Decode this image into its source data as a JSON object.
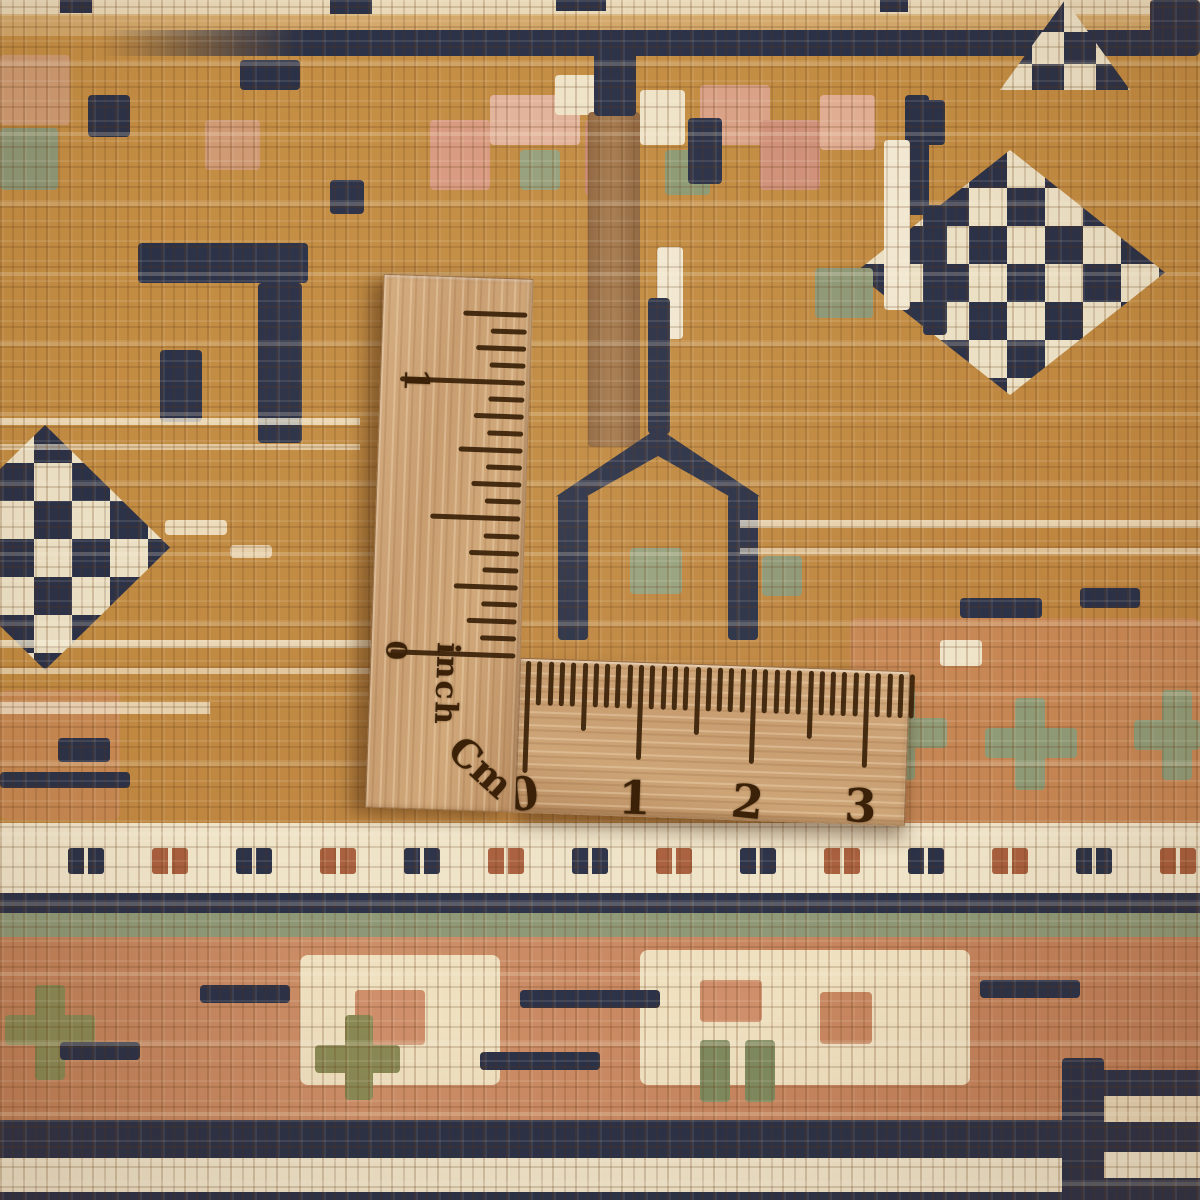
{
  "ruler": {
    "inch_scale": {
      "label": "inch",
      "one": "1",
      "zero": "0"
    },
    "cm_scale": {
      "label": "Cm",
      "numbers": [
        "0",
        "1",
        "2",
        "3"
      ]
    },
    "colors": {
      "wood": "#c89e71",
      "burn_marks": "#3a2108"
    }
  },
  "carpet": {
    "colors": {
      "gold_field": "#c18a41",
      "navy": "#2b3147",
      "cream": "#efe4c9",
      "salmon": "#cf8f6b",
      "rust": "#a85f3d",
      "sage": "#8e9877",
      "olive": "#8a8a55",
      "brown": "#9d7248"
    }
  }
}
